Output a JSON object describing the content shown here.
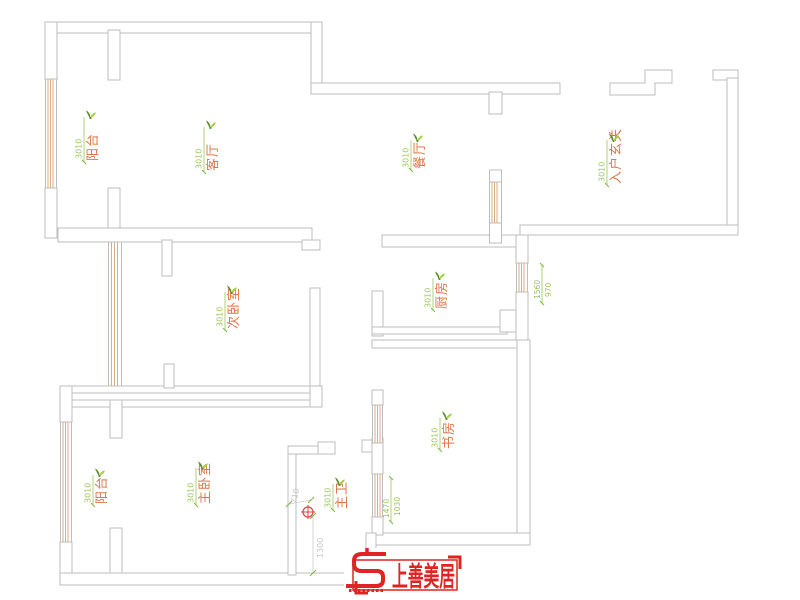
{
  "plan": {
    "room_labels": [
      {
        "id": "balcony-top",
        "name": "阳台",
        "dim": "3010"
      },
      {
        "id": "living-room",
        "name": "客厅",
        "dim": "3010"
      },
      {
        "id": "dining-room",
        "name": "餐厅",
        "dim": "3010"
      },
      {
        "id": "entry-hall",
        "name": "入户玄关",
        "dim": "3010"
      },
      {
        "id": "second-bedroom",
        "name": "次卧室",
        "dim": "3010"
      },
      {
        "id": "kitchen",
        "name": "厨房",
        "dim": "3010"
      },
      {
        "id": "study",
        "name": "书房",
        "dim": "3010"
      },
      {
        "id": "master-bedroom",
        "name": "主卧室",
        "dim": "3010"
      },
      {
        "id": "balcony-bottom",
        "name": "阳台",
        "dim": "3010"
      },
      {
        "id": "master-bath",
        "name": "主卫",
        "dim": "3010"
      }
    ],
    "window_dims": [
      {
        "id": "kitchen-window",
        "a": "1560",
        "b": "970"
      },
      {
        "id": "study-window",
        "a": "1470",
        "b": "1030"
      }
    ],
    "measurements": {
      "width": "710",
      "height": "1300"
    },
    "colors": {
      "wall": "#bdbdbd",
      "window": "#d8ae85",
      "label_green": "#9cc65a",
      "label_orange": "#e0764b",
      "dim_gray": "#c6c6c6",
      "brand_red": "#e02323"
    }
  },
  "logo": {
    "brand": "上善美居"
  }
}
